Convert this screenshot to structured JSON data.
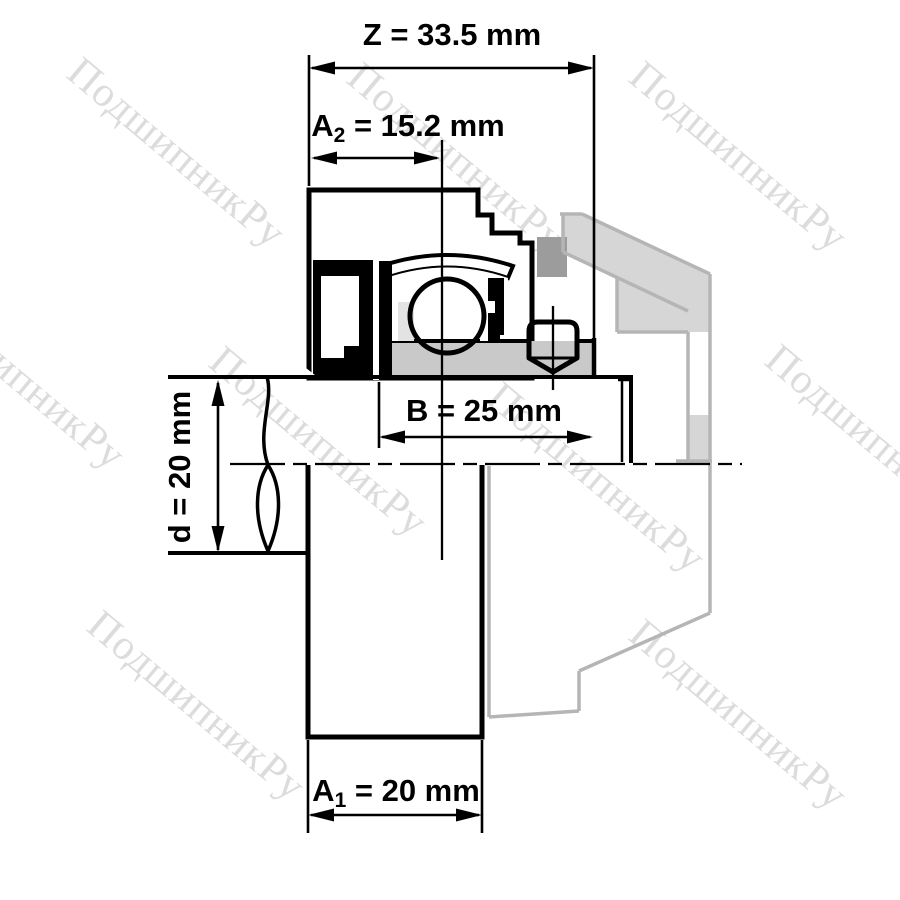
{
  "drawing": {
    "type": "bearing-unit-technical-drawing",
    "watermark": "ПодшипникРу",
    "dimensions": {
      "z": {
        "text": "Z = 33.5 mm"
      },
      "a2": {
        "base": "A",
        "sub": "2",
        "rest": " = 15.2 mm"
      },
      "b": {
        "text": "B = 25 mm"
      },
      "d": {
        "text": "d = 20 mm"
      },
      "a1": {
        "base": "A",
        "sub": "1",
        "rest": " = 20 mm"
      }
    },
    "colors": {
      "outline": "#000000",
      "part_fill": "#c9c9c9",
      "part_fill_dark": "#9c9c9c",
      "pocket_fill": "#e3e3e3",
      "ghost_stroke": "#b5b5b5",
      "ghost_fill": "#d6d6d6",
      "watermark_color": "#dcdcdc",
      "background": "#ffffff"
    }
  }
}
